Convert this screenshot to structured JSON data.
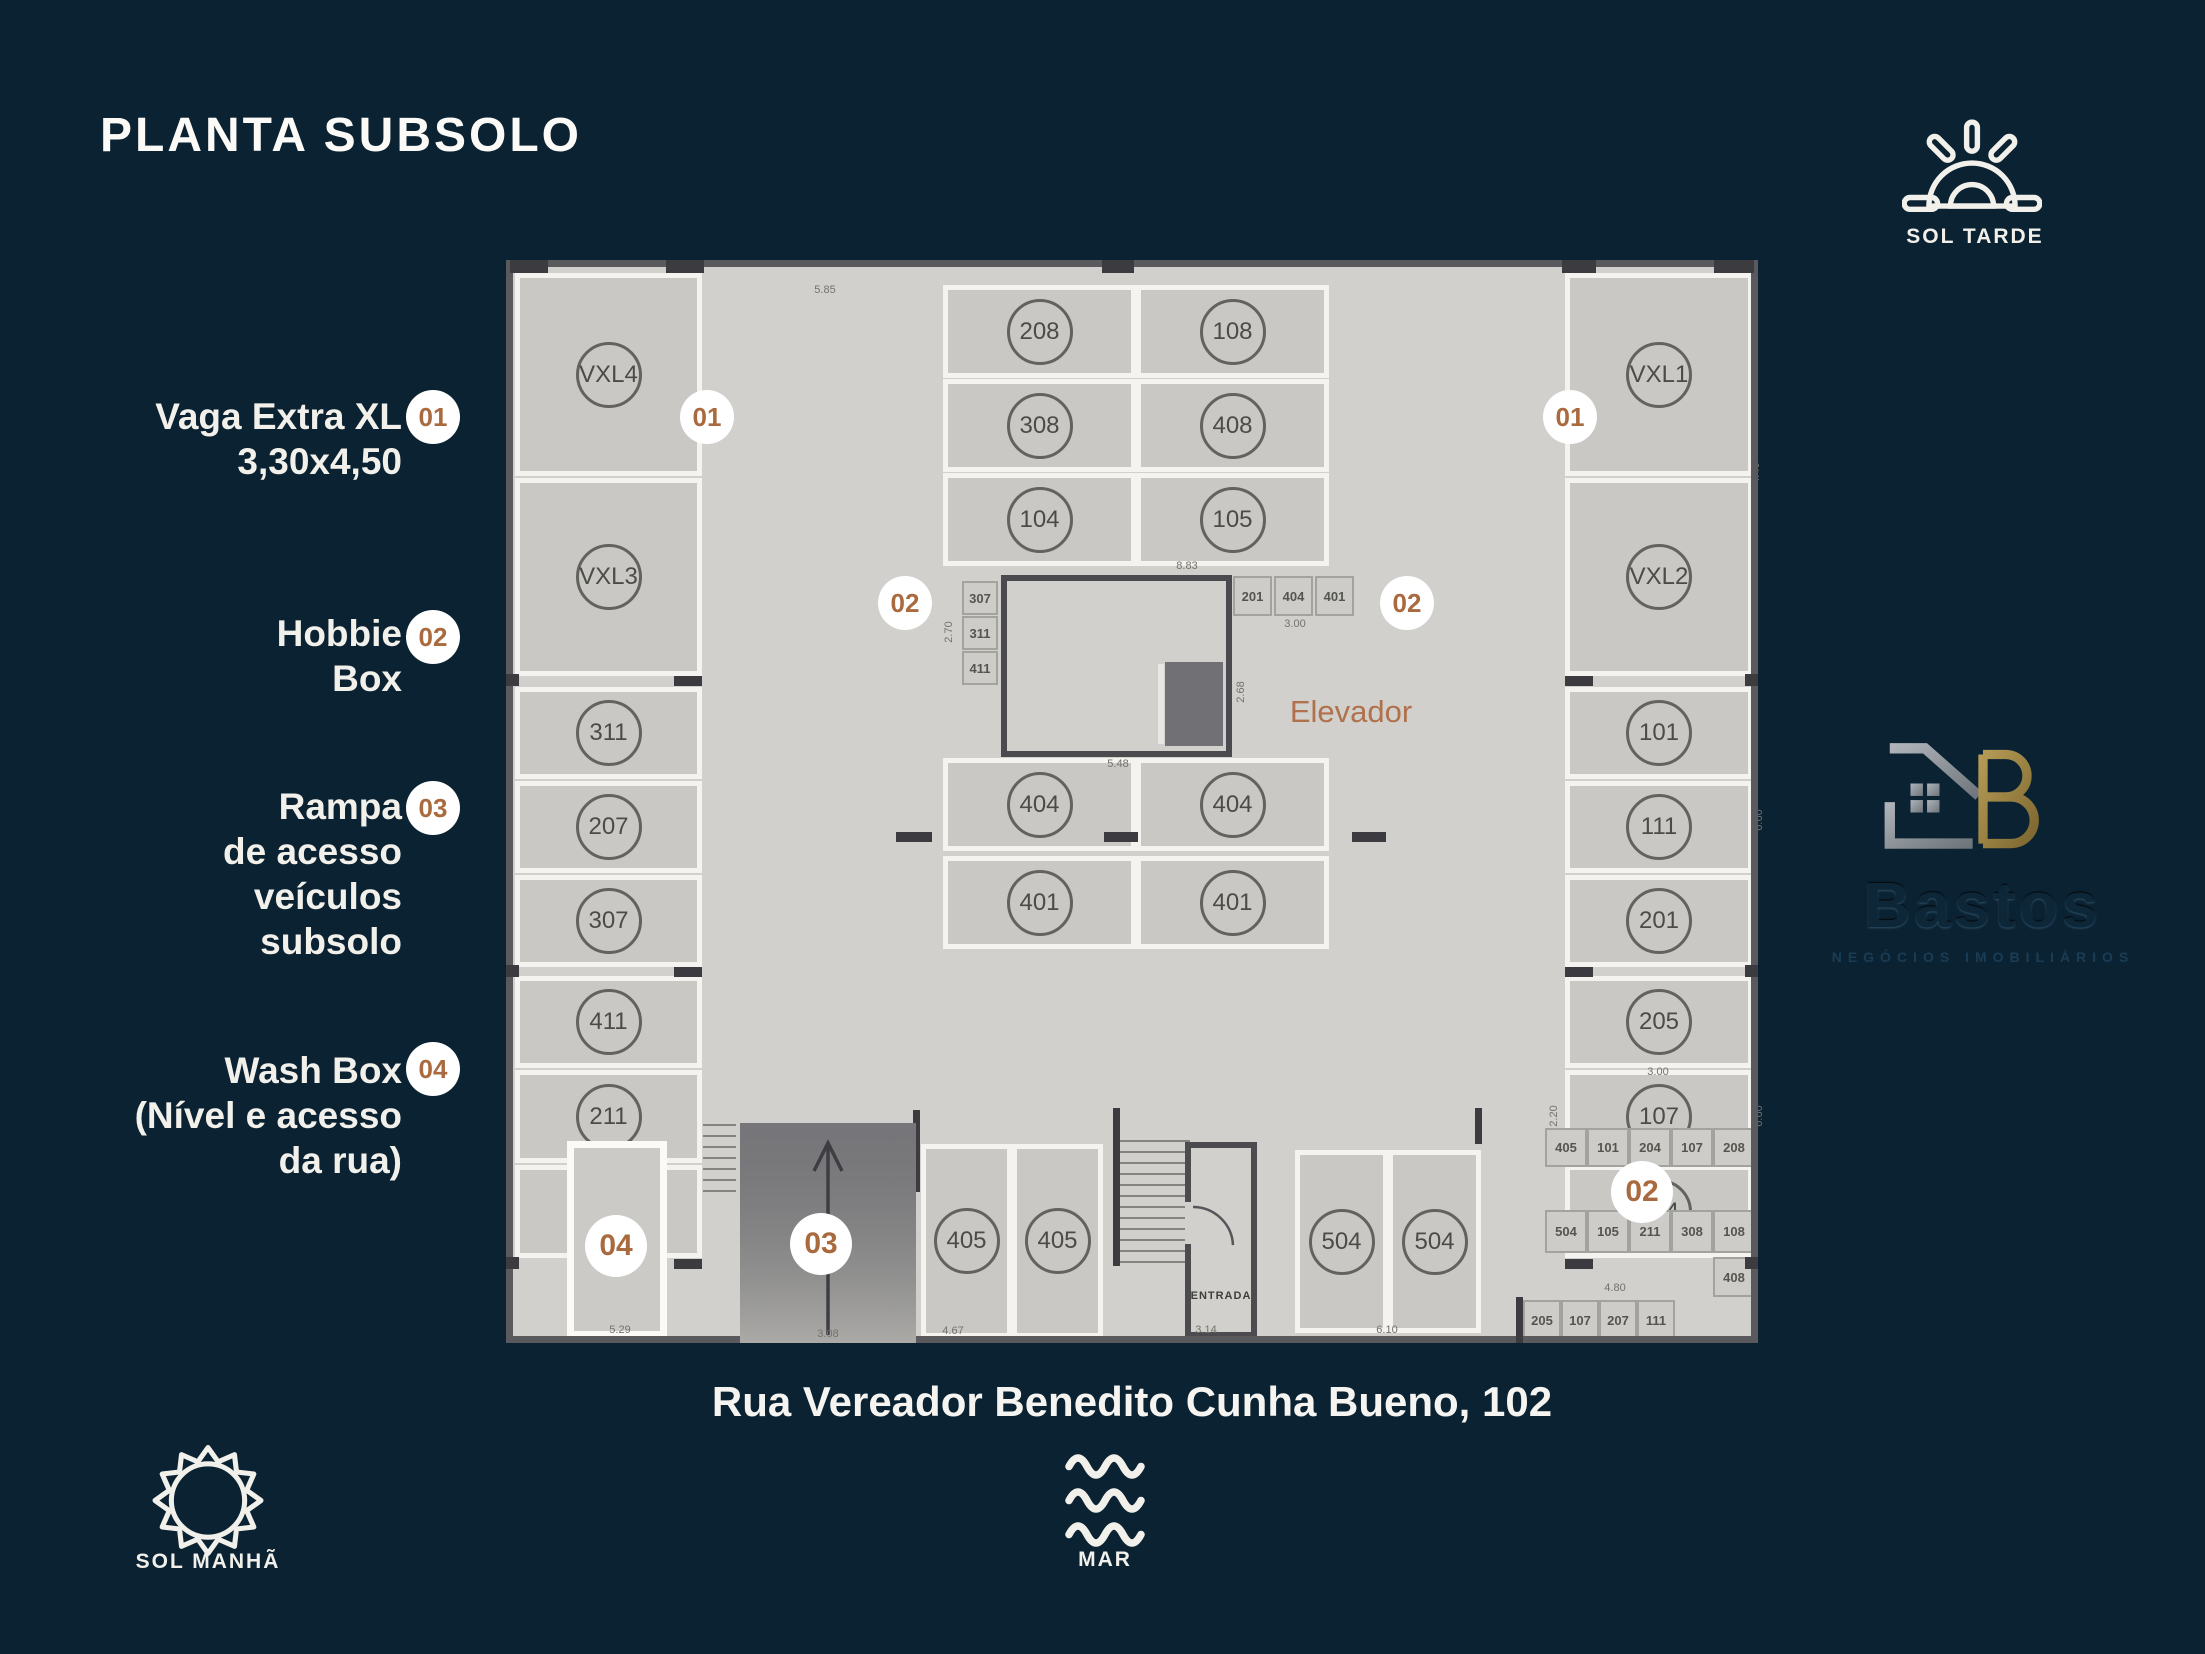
{
  "title": "PLANTA SUBSOLO",
  "address": "Rua Vereador Benedito Cunha Bueno, 102",
  "legend": [
    {
      "num": "01",
      "lines": [
        "Vaga Extra XL",
        "3,30x4,50"
      ]
    },
    {
      "num": "02",
      "lines": [
        "Hobbie",
        "Box"
      ]
    },
    {
      "num": "03",
      "lines": [
        "Rampa",
        "de acesso",
        "veículos",
        "subsolo"
      ]
    },
    {
      "num": "04",
      "lines": [
        "Wash Box",
        "(Nível e acesso",
        "da rua)"
      ]
    }
  ],
  "compass": {
    "sol_tarde": "SOL TARDE",
    "sol_manha": "SOL MANHÃ",
    "mar": "MAR"
  },
  "logo": {
    "name": "Bastos",
    "subtitle": "NEGÓCIOS IMOBILIÁRIOS"
  },
  "plan": {
    "badge_01": "01",
    "badge_02": "02",
    "badge_03": "03",
    "badge_04": "04",
    "labels": {
      "escada": "ESCADA",
      "entrada": "ENTRADA",
      "elevador": "Elevador"
    },
    "left_stalls": [
      "VXL4",
      "VXL3",
      "311",
      "207",
      "307",
      "411",
      "211",
      "502"
    ],
    "right_stalls": [
      "VXL1",
      "VXL2",
      "101",
      "111",
      "201",
      "205",
      "107",
      "204"
    ],
    "top_block": [
      "208",
      "108",
      "308",
      "408",
      "104",
      "105"
    ],
    "mid_block": [
      "404",
      "404",
      "401",
      "401"
    ],
    "bottom_405": [
      "405",
      "405"
    ],
    "bottom_504": [
      "504",
      "504"
    ],
    "core_left_boxes": [
      "307",
      "311",
      "411"
    ],
    "core_right_boxes": [
      "201",
      "404",
      "401"
    ],
    "hgrid_row1": [
      "405",
      "101",
      "204",
      "107",
      "208"
    ],
    "hgrid_row2": [
      "504",
      "105",
      "211",
      "308"
    ],
    "hgrid_108": "108",
    "hgrid_408": "408",
    "hgrid_row3": [
      "205",
      "107",
      "207",
      "111"
    ],
    "dims": {
      "top_left": "5.85",
      "core_top": "8.83",
      "core_left": "2.70",
      "core_right": "3.00",
      "core_bottom": "5.48",
      "elev_right": "2.68",
      "right_top": "4.40",
      "right_mid": "6.60",
      "right_107_top": "3.00",
      "right_107_left": "2.20",
      "right_107_right": "6.60",
      "washbox": "5.29",
      "ramp": "3.08",
      "s405": "4.67",
      "entrada": "3.14",
      "s504": "6.10",
      "hgrid": "4.80"
    }
  },
  "colors": {
    "background": "#0b2232",
    "accent": "#a96a3f",
    "floor": "#d1d0cc",
    "wall": "#5a5a5e",
    "stall_line": "#f4f3ef"
  }
}
